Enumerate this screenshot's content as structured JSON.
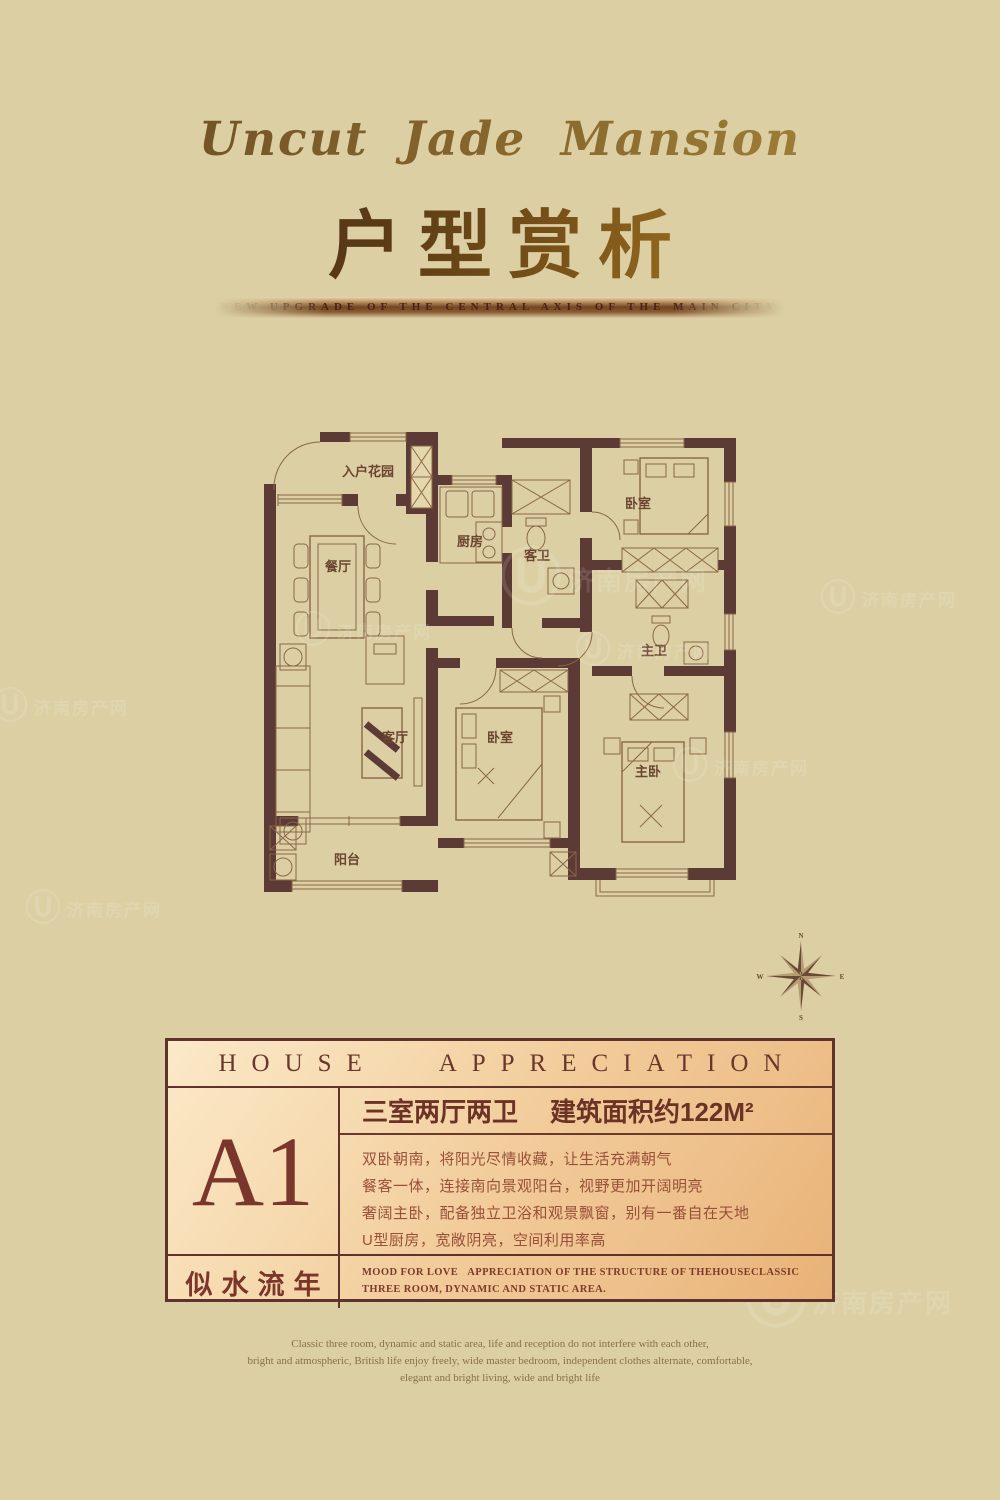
{
  "header": {
    "script_title": "Uncut Jade Mansion",
    "main_title": "户型赏析",
    "ribbon_text": "NEW UPGRADE OF THE CENTRAL AXIS OF THE MAIN CITY"
  },
  "floor_plan": {
    "rooms": [
      {
        "id": "entry-garden",
        "label": "入户花园"
      },
      {
        "id": "kitchen",
        "label": "厨房"
      },
      {
        "id": "guest-bath",
        "label": "客卫"
      },
      {
        "id": "bedroom-north",
        "label": "卧室"
      },
      {
        "id": "dining",
        "label": "餐厅"
      },
      {
        "id": "master-bath",
        "label": "主卫"
      },
      {
        "id": "living",
        "label": "客厅"
      },
      {
        "id": "bedroom-middle",
        "label": "卧室"
      },
      {
        "id": "master-bedroom",
        "label": "主卧"
      },
      {
        "id": "balcony",
        "label": "阳台"
      }
    ],
    "compass": {
      "n": "N",
      "e": "E",
      "s": "S",
      "w": "W"
    }
  },
  "watermark": {
    "logo": "Ⓤ",
    "text": "济南房产网"
  },
  "card": {
    "header": "HOUSE APPRECIATION",
    "unit": "A1",
    "spec": "三室两厅两卫",
    "area": "建筑面积约122M²",
    "features": [
      "双卧朝南，将阳光尽情收藏，让生活充满朝气",
      "餐客一体，连接南向景观阳台，视野更加开阔明亮",
      "奢阔主卧，配备独立卫浴和观景飘窗，别有一番自在天地",
      "U型厨房，宽敞阴亮，空间利用率高"
    ],
    "slogan": "似水流年",
    "caption_en": "MOOD FOR LOVE   APPRECIATION OF THE STRUCTURE OF THEHOUSECLASSIC\nTHREE ROOM, DYNAMIC AND STATIC AREA."
  },
  "footer": {
    "text": "Classic three room, dynamic and static area, life and reception do not interfere with each other,\nbright and atmospheric, British life enjoy freely, wide master bedroom, independent clothes alternate, comfortable,\nelegant and bright living, wide and bright life"
  },
  "colors": {
    "background": "#dbcfa3",
    "wall": "#5c3a36",
    "plan_line": "#8a6747",
    "maroon_text": "#7b362b",
    "gold": "#b8922f",
    "card_border": "#5f332b",
    "card_gradient_start": "#fbe9c8",
    "card_gradient_end": "#e8b276"
  }
}
